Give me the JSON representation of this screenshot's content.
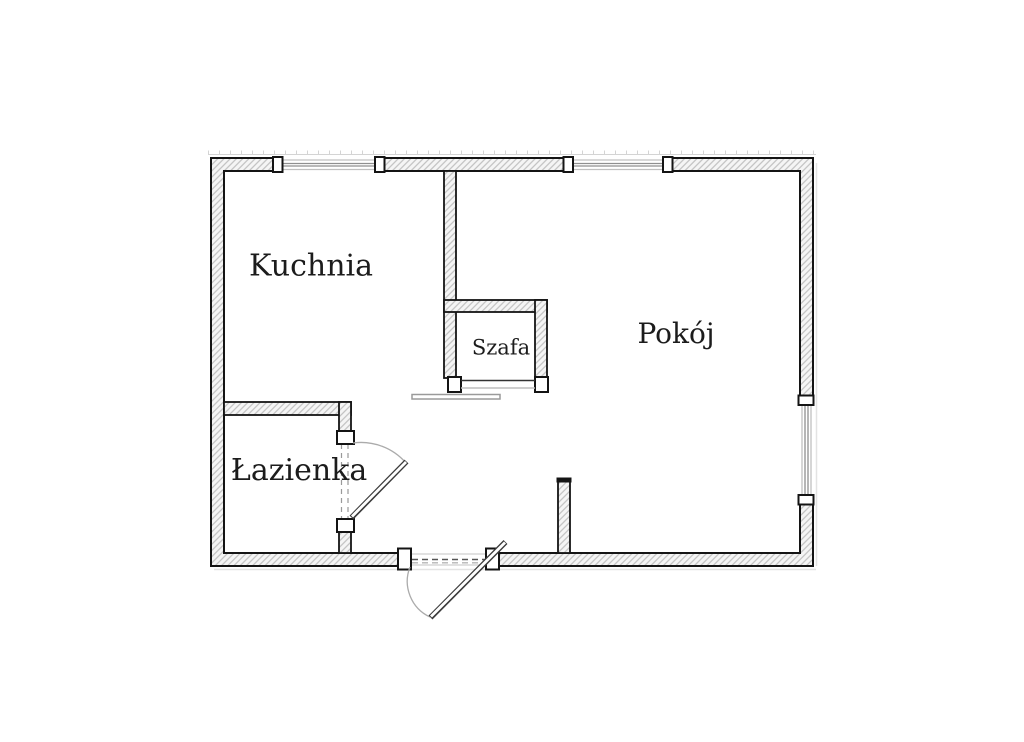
{
  "plan": {
    "rooms": {
      "kitchen": "Kuchnia",
      "living_room": "Pokój",
      "wardrobe": "Szafa",
      "bathroom": "Łazienka"
    },
    "colors": {
      "wall_outline": "#141414",
      "wall_hatch": "#bcbcbc",
      "wall_fill": "#f5f5f5",
      "glazing": "#8f8f8f",
      "door_arc": "#aaaaaa",
      "background": "#ffffff"
    }
  }
}
